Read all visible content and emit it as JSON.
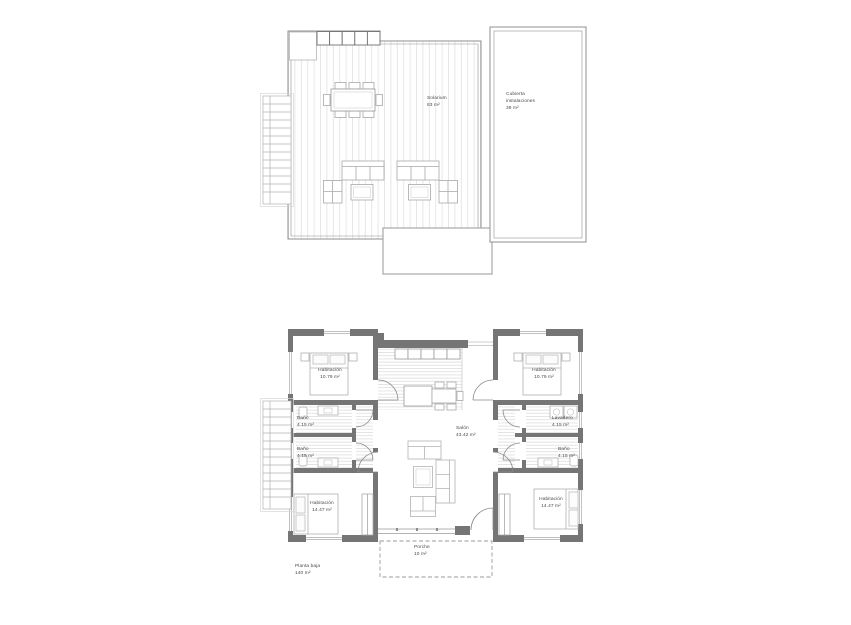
{
  "upper_plan": {
    "solarium_label": "Solarium",
    "solarium_area": "83 m²",
    "cubierta_line1": "Cubierta",
    "cubierta_line2": "instalaciones",
    "cubierta_area": "39 m²"
  },
  "lower_plan": {
    "hab_tl_label": "Habitación",
    "hab_tl_area": "10.79 m²",
    "hab_tr_label": "Habitación",
    "hab_tr_area": "10.79 m²",
    "bano_l1_label": "Baño",
    "bano_l1_area": "4.15 m²",
    "bano_l2_label": "Baño",
    "bano_l2_area": "4.15 m²",
    "lavadero_label": "Lavadero",
    "lavadero_area": "4.15 m²",
    "bano_r_label": "Baño",
    "bano_r_area": "4.15 m²",
    "hab_bl_label": "Habitación",
    "hab_bl_area": "14.47 m²",
    "hab_br_label": "Habitación",
    "hab_br_area": "14.47 m²",
    "salon_label": "Salón",
    "salon_area": "43.42 m²",
    "porche_label": "Porche",
    "porche_area": "10 m²",
    "floor_label": "Planta baja",
    "floor_area": "140 m²"
  },
  "colors": {
    "wall": "#757575",
    "outline": "#8f8f8f",
    "furniture": "#ababab",
    "text": "#4a4a4a"
  }
}
